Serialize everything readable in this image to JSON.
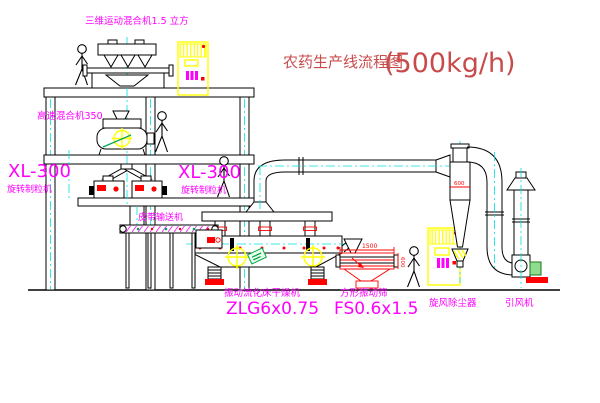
{
  "title": {
    "name": "农药生产线流程图",
    "capacity": "(500kg/h)"
  },
  "equipment_labels": {
    "mixer_3d": "三维运动混合机1.5 立方",
    "high_speed_mixer": "高速混合机350",
    "granulator_left": {
      "model": "XL-300",
      "name": "旋转制粒机"
    },
    "granulator_center": {
      "model": "XL-300",
      "name": "旋转制粒机"
    },
    "belt_conveyor": "皮带输送机",
    "fluid_bed_dryer": {
      "name": "振动流化床干燥机",
      "model": "ZLG6x0.75"
    },
    "vibrating_screen": {
      "name": "方形振动筛",
      "model": "FS0.6x1.5"
    },
    "cyclone": "旋风除尘器",
    "induced_draft_fan": "引风机"
  },
  "dimensions": {
    "screen_length": "1500",
    "screen_width": "600",
    "cyclone_diameter": "600"
  },
  "colors": {
    "label_magenta": "#FF00FF",
    "title_red": "#C84B4B",
    "dimension_red": "#FF0000",
    "cabinet_yellow": "#FFFF00",
    "centerline_cyan": "#00E0E0",
    "accent_green": "#00A650"
  }
}
